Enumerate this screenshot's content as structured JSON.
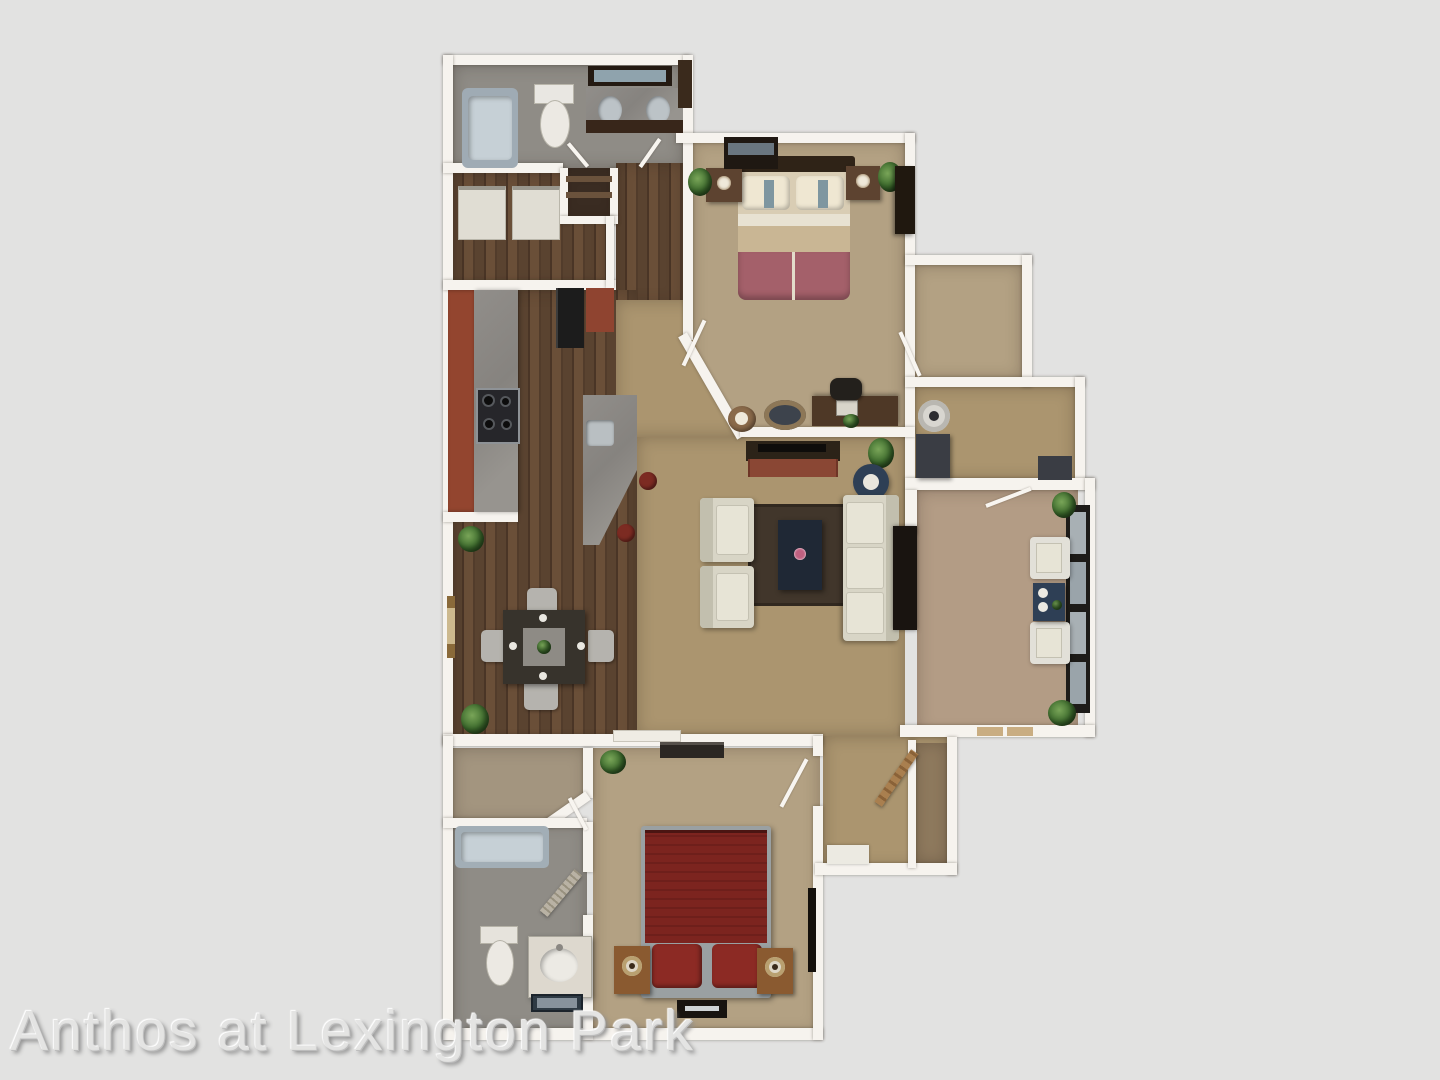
{
  "watermark": {
    "text": "Anthos at Lexington Park"
  },
  "scene": {
    "type": "3d-floor-plan-rendering",
    "property_name": "Anthos at Lexington Park",
    "layout": "2 bedroom / 2 bathroom apartment with kitchen, dining, living room, sunroom, laundry and walk-in closets"
  },
  "palette": {
    "background": "#e2e2e1",
    "walls": "#f6f3ee",
    "carpet_living": "#ab956f",
    "carpet_bedroom": "#b3a183",
    "carpet_sunroom": "#b39c85",
    "wood_floor": "#5a4330",
    "bathroom_floor": "#8f8c86",
    "counter_brick": "#93452f",
    "counter_granite": "#8b8885",
    "bed1_accent": "#a4606a",
    "bed2_red": "#7c241f",
    "sofa_cream": "#d8d5c6",
    "table_navy": "#2e3f55",
    "plant_green": "#3c6a2c"
  },
  "rooms": [
    {
      "name": "bathroom-1",
      "furniture": [
        "bathtub",
        "toilet",
        "double-vanity",
        "mirror",
        "tall-cabinet"
      ]
    },
    {
      "name": "laundry-closet",
      "furniture": [
        "washer",
        "dryer"
      ]
    },
    {
      "name": "linen-closet",
      "furniture": [
        "shelves"
      ]
    },
    {
      "name": "kitchen",
      "furniture": [
        "brick-granite-counter",
        "stove",
        "refrigerator",
        "pantry-cabinet",
        "peninsula-with-sink",
        "two-bar-stools"
      ]
    },
    {
      "name": "dining-room",
      "furniture": [
        "dining-table",
        "four-chairs",
        "plants"
      ]
    },
    {
      "name": "bedroom-1",
      "furniture": [
        "queen-bed",
        "two-nightstands",
        "tv-console",
        "armoire",
        "desk",
        "desk-chair",
        "ottoman",
        "side-table",
        "plants"
      ]
    },
    {
      "name": "walk-in-closet",
      "furniture": []
    },
    {
      "name": "laundry-room",
      "furniture": [
        "washer",
        "dryer-counter"
      ]
    },
    {
      "name": "living-room",
      "furniture": [
        "media-console",
        "two-armchairs",
        "sofa",
        "rug",
        "coffee-table",
        "round-side-table",
        "tv-cabinet",
        "plant"
      ]
    },
    {
      "name": "sunroom",
      "furniture": [
        "two-patio-chairs",
        "patio-table",
        "window-wall",
        "plants",
        "door-mats"
      ]
    },
    {
      "name": "entry-hall",
      "furniture": [
        "coat-closet",
        "wood-door",
        "entry-mat"
      ]
    },
    {
      "name": "bedroom-2",
      "furniture": [
        "red-bed",
        "two-nightstands-with-lamps",
        "dresser",
        "wall-tv",
        "floor-tv"
      ]
    },
    {
      "name": "bathroom-2",
      "furniture": [
        "bathtub",
        "toilet",
        "vanity",
        "bath-mat"
      ]
    }
  ]
}
